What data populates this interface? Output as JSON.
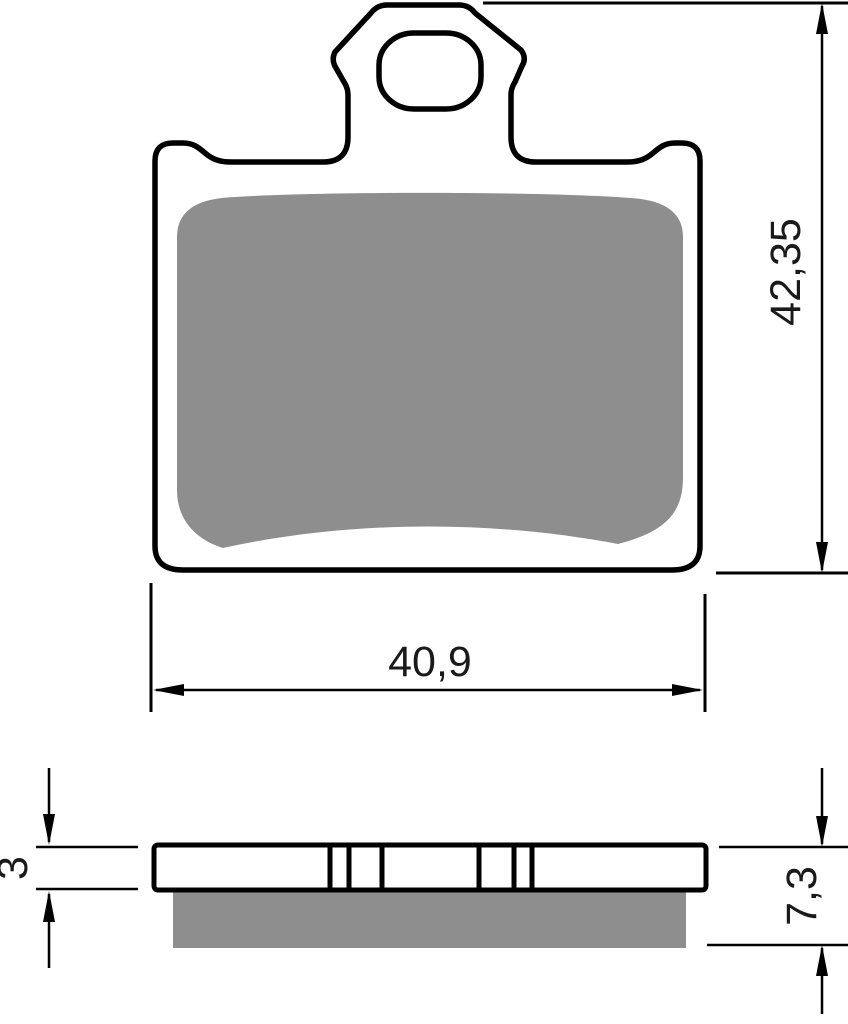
{
  "dimensions": {
    "front_width": "40,9",
    "front_height": "42,35",
    "backplate_thickness": "3",
    "total_thickness": "7,3"
  },
  "colors": {
    "outline": "#000000",
    "friction_material": "#8e8e8e",
    "background": "#ffffff"
  }
}
